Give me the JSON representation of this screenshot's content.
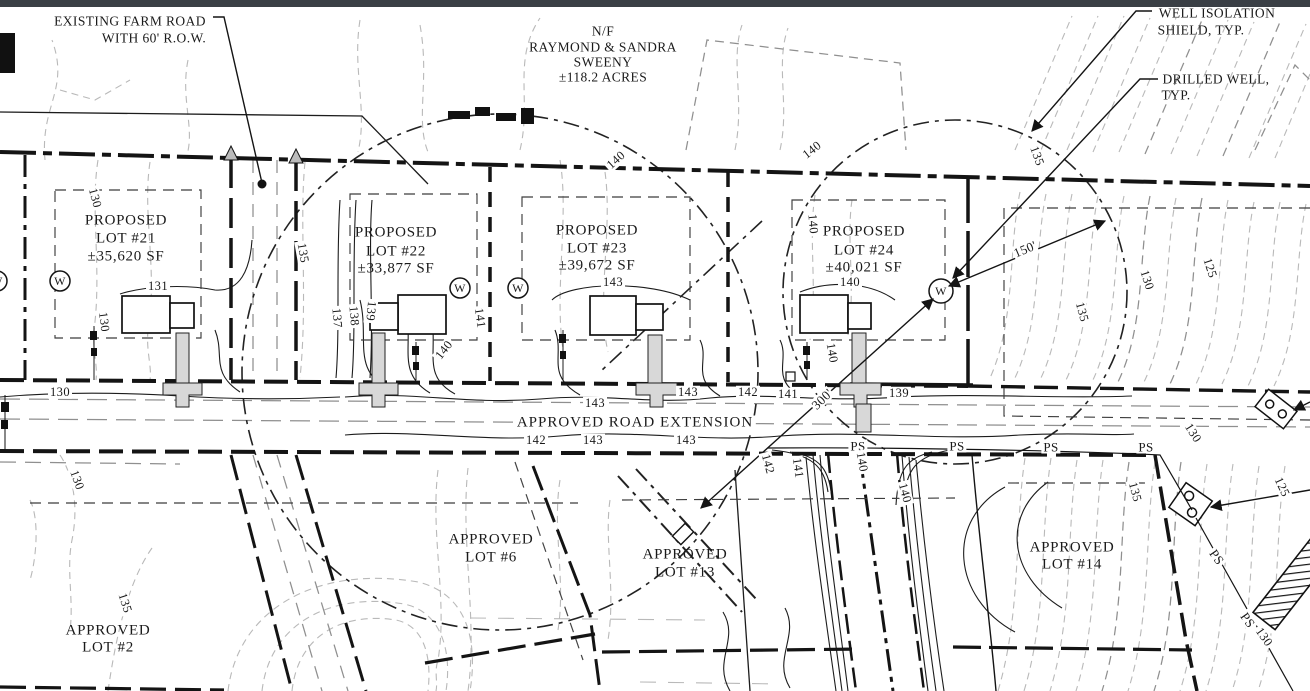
{
  "colors": {
    "paper": "#ffffff",
    "ink": "#1a1a1a",
    "contour_light": "#b9b9b9",
    "contour_mid": "#8f8f8f",
    "driveway_fill": "#d8d8d8",
    "top_bar": "#3a3f45"
  },
  "callouts": {
    "existing_farm_road": {
      "line1": "EXISTING FARM ROAD",
      "line2": "WITH 60' R.O.W."
    },
    "neighbor": {
      "line1": "N/F",
      "line2": "RAYMOND & SANDRA",
      "line3": "SWEENY",
      "line4": "±118.2 ACRES"
    },
    "well_isolation_shield": {
      "line1": "WELL ISOLATION",
      "line2": "SHIELD, TYP."
    },
    "drilled_well": {
      "line1": "DRILLED WELL,",
      "line2": "TYP."
    }
  },
  "road_label": "APPROVED ROAD EXTENSION",
  "proposed_lots": [
    {
      "name": "PROPOSED",
      "lot": "LOT #21",
      "area": "±35,620 SF"
    },
    {
      "name": "PROPOSED",
      "lot": "LOT #22",
      "area": "±33,877 SF"
    },
    {
      "name": "PROPOSED",
      "lot": "LOT #23",
      "area": "±39,672 SF"
    },
    {
      "name": "PROPOSED",
      "lot": "LOT #24",
      "area": "±40,021 SF"
    }
  ],
  "approved_lots": [
    {
      "name": "APPROVED",
      "lot": "LOT #6"
    },
    {
      "name": "APPROVED",
      "lot": "LOT #13"
    },
    {
      "name": "APPROVED",
      "lot": "LOT #14"
    },
    {
      "name": "APPROVED",
      "lot": "LOT #2"
    }
  ],
  "dimensions": {
    "well_radius": "150'",
    "well_spacing": "300'"
  },
  "well_symbol": "W",
  "utility_label": "PS",
  "contour_labels": [
    "130",
    "131",
    "130",
    "130",
    "130",
    "135",
    "135",
    "137",
    "138",
    "139",
    "140",
    "141",
    "140",
    "140",
    "143",
    "143",
    "143",
    "142",
    "141",
    "139",
    "142",
    "143",
    "143",
    "140",
    "140",
    "140",
    "142",
    "141",
    "140",
    "135",
    "130",
    "125",
    "130",
    "135",
    "135",
    "125",
    "130",
    "140"
  ]
}
